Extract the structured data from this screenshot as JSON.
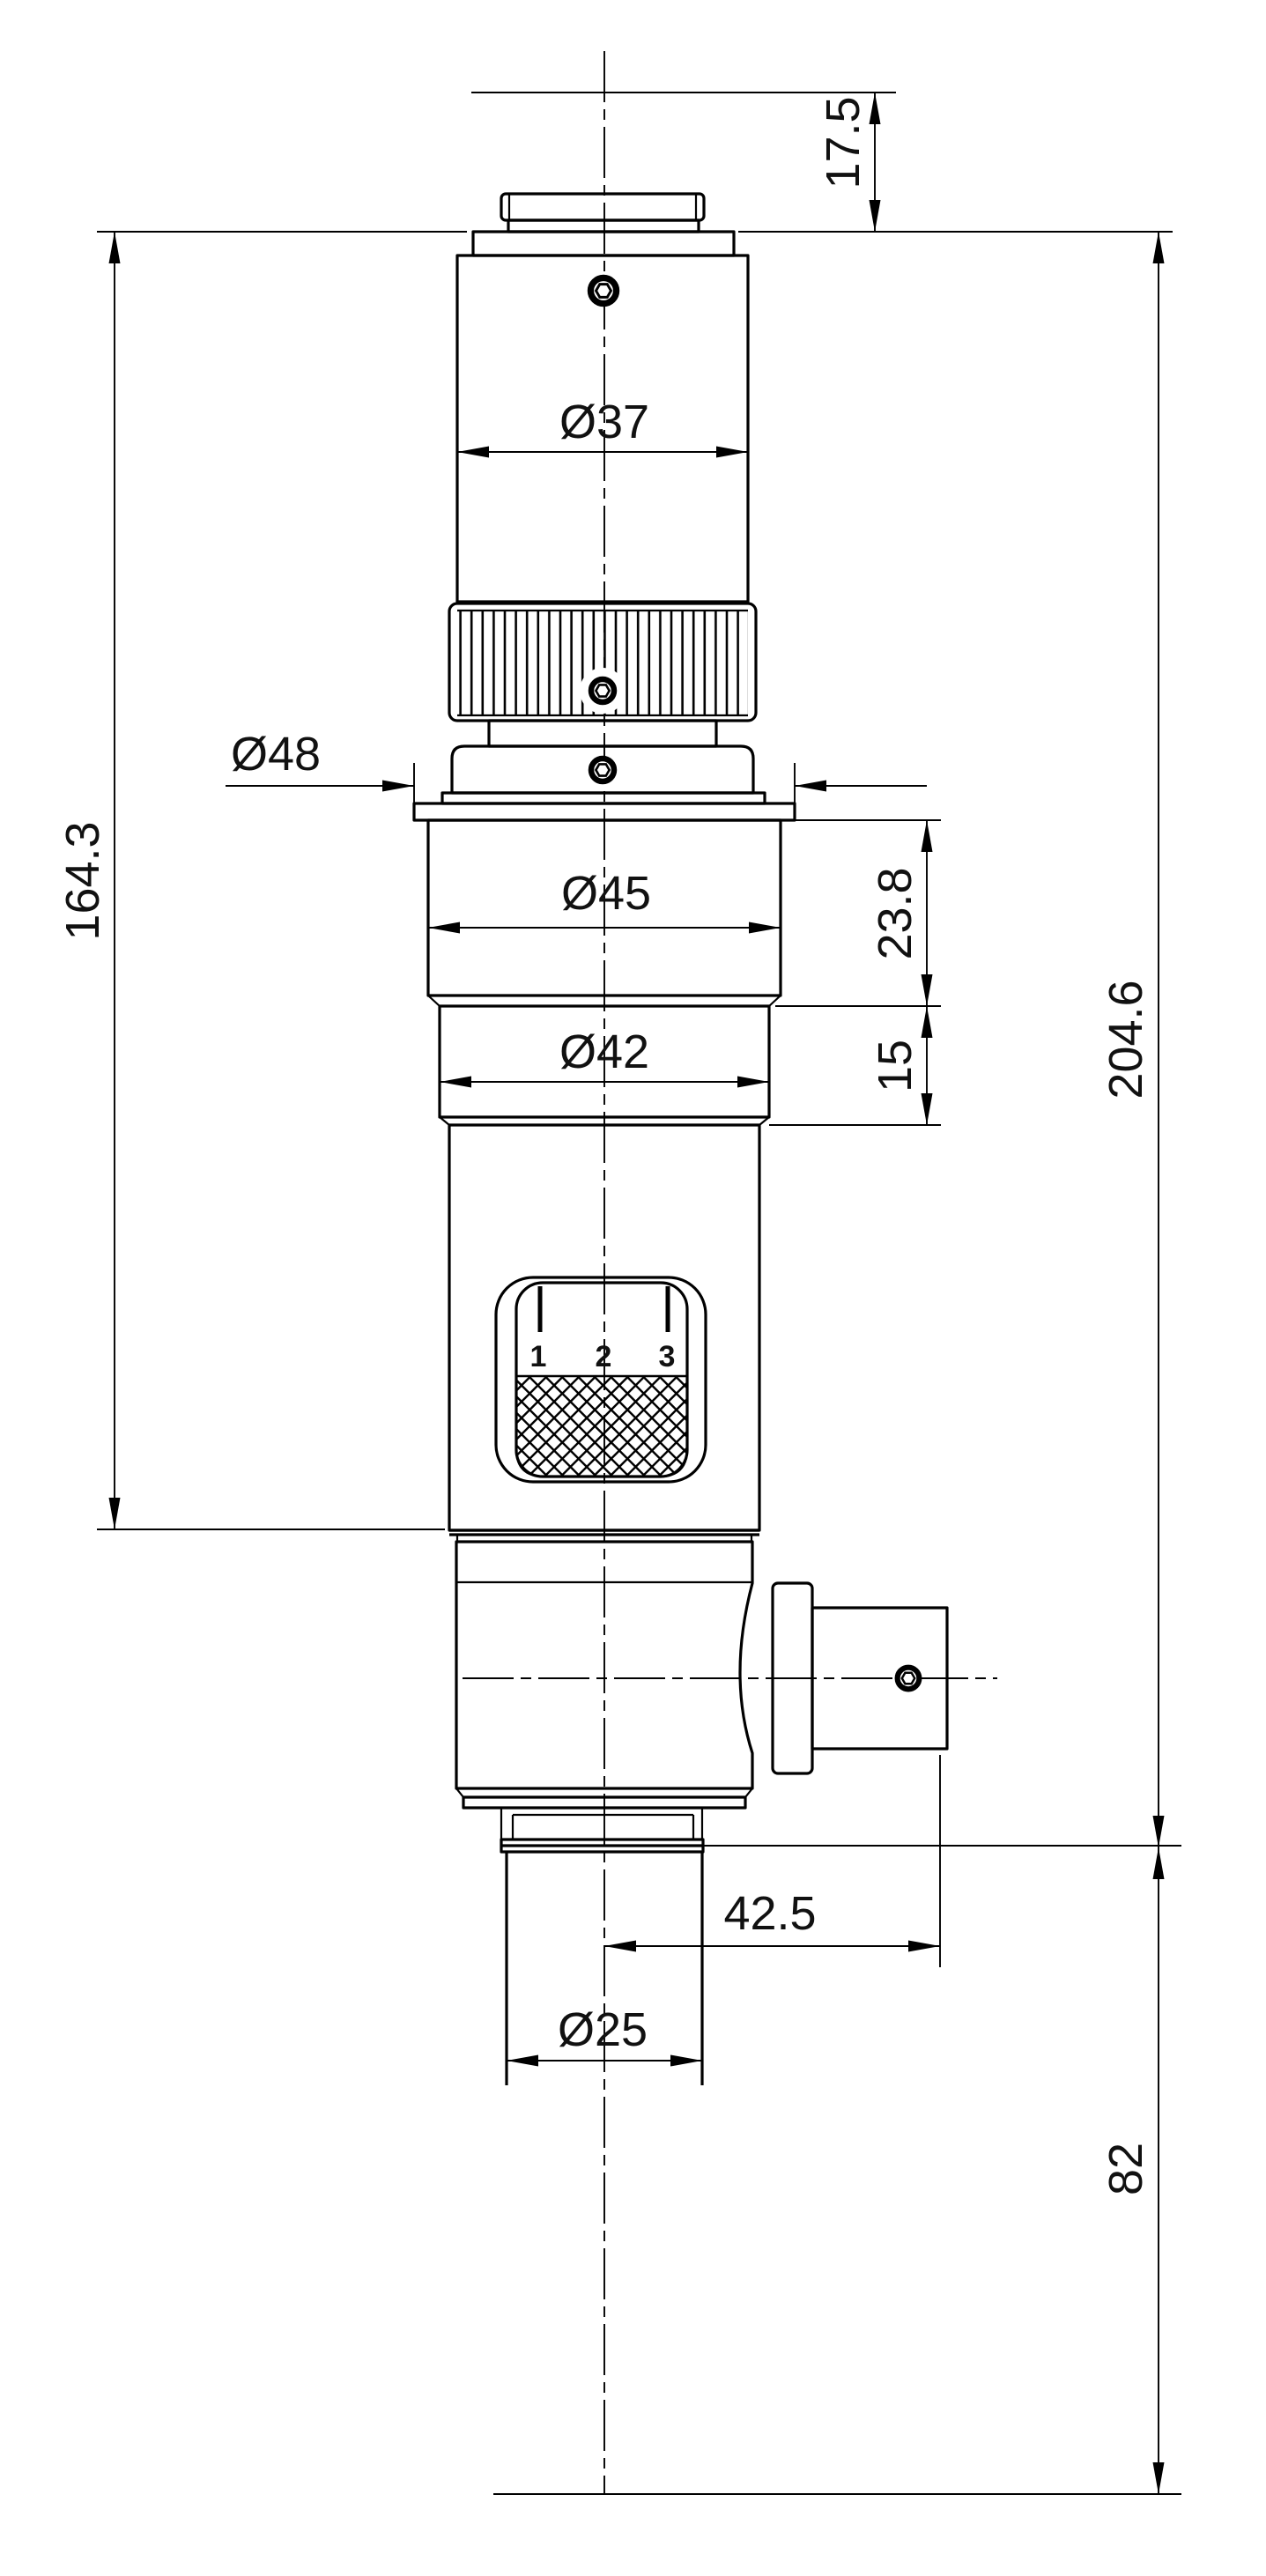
{
  "drawing": {
    "kind": "technical-dimension-drawing",
    "units_implied": "mm",
    "colors": {
      "line": "#000000",
      "background": "#ffffff",
      "text": "#111111"
    }
  },
  "dimensions": {
    "top_offset": {
      "label": "17.5"
    },
    "eyepiece_diameter": {
      "label": "Ø37"
    },
    "flange_diameter": {
      "label": "Ø48"
    },
    "upper_diameter": {
      "label": "Ø45"
    },
    "upper_height": {
      "label": "23.8"
    },
    "mid_diameter": {
      "label": "Ø42"
    },
    "mid_height": {
      "label": "15"
    },
    "body_height": {
      "label": "164.3"
    },
    "overall_height": {
      "label": "204.6"
    },
    "knob_offset": {
      "label": "42.5"
    },
    "mount_diameter": {
      "label": "Ø25"
    },
    "lower_extension": {
      "label": "82"
    }
  },
  "zoom_scale_window": {
    "labels": [
      "1",
      "2",
      "3"
    ]
  }
}
